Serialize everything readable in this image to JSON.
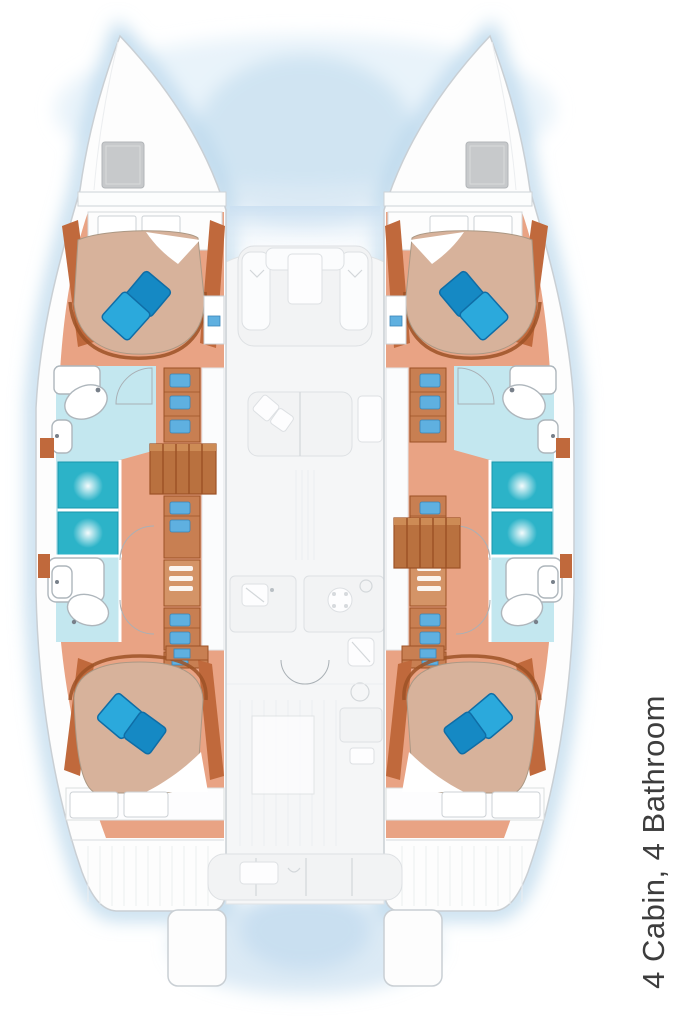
{
  "caption": {
    "text": "4 Cabin, 4 Bathroom"
  },
  "plan": {
    "type": "catamaran floor plan, top view",
    "cabins": "4",
    "bathrooms": "4"
  },
  "semantics": {
    "icons": [
      "double-bed",
      "pillow",
      "shower-pan",
      "washbasin",
      "toilet",
      "cooktop-icon",
      "galley-sink-icon",
      "companionway-stairs",
      "bow-hatch",
      "cockpit-bench",
      "salon-settee",
      "storage-cabinet",
      "door-swing-arc",
      "transom-platform"
    ]
  },
  "palette": {
    "glow": "#b7d6ec",
    "glow_light": "#ddecf8",
    "hull_fill": "#fdfdfd",
    "hull_stroke": "#c9cfd4",
    "deck_fill": "#f5f6f7",
    "deck_stroke": "#e0e3e5",
    "furniture_fill": "#f2f3f4",
    "furniture_stroke": "#dde0e3",
    "furniture_bright": "#fbfcfd",
    "wood_floor": "#e9a384",
    "wood_trim": "#c0693c",
    "wood_trim_dark": "#9c5226",
    "wood_cabinet": "#c87f52",
    "wood_cabinet_light": "#d49467",
    "steps_wood": "#b9713f",
    "steps_light": "#cd8b55",
    "mattress": "#d7b29b",
    "mattress_stroke": "#ab9884",
    "pillow_bright": "#2ba9dc",
    "pillow_dark": "#1589c4",
    "pillow_stroke": "#0f6da6",
    "shower": "#2cb3c8",
    "shower_stroke": "#1797ad",
    "bath_floor": "#c3e7ef",
    "fixture_fill": "#ffffff",
    "fixture_stroke": "#aeb6bc",
    "hatch": "#c7c9cb",
    "content_blue": "#5fb0e0",
    "content_blue_dark": "#3a85b8",
    "planking": "#eceef0",
    "arc_line": "#a9b0b5",
    "detail_line": "#d3d7da",
    "text": "#3d3d3d"
  }
}
